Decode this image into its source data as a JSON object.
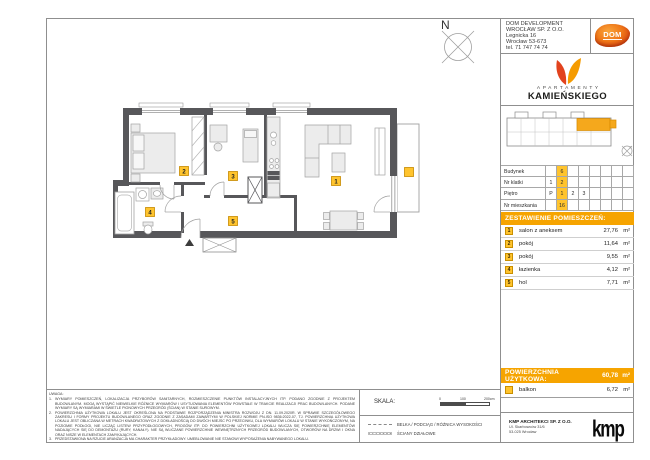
{
  "colors": {
    "accent_orange": "#F6A400",
    "highlight_yellow": "#FFC42E",
    "wall_gray": "#57575A",
    "logo_red": "#E2431E",
    "logo_orange": "#F59B00"
  },
  "header": {
    "developer_lines": [
      "DOM DEVELOPMENT",
      "WROCŁAW SP. Z O.O.",
      "Legnicka 16",
      "Wrocław 53-673",
      "tel. 71 747 74 74"
    ],
    "dom_logo_text": "DOM",
    "brand_sub": "APARTAMENTY",
    "brand_main": "KAMIEŃSKIEGO"
  },
  "compass_label": "N",
  "unit_table": {
    "rows": [
      {
        "label": "Budynek",
        "cells": [
          "",
          "6",
          "",
          "",
          "",
          "",
          "",
          ""
        ]
      },
      {
        "label": "Nr klatki",
        "cells": [
          "1",
          "2",
          "",
          "",
          "",
          "",
          "",
          ""
        ]
      },
      {
        "label": "Piętro",
        "cells": [
          "P",
          "1",
          "2",
          "3",
          "",
          "",
          "",
          ""
        ]
      },
      {
        "label": "Nr mieszkania",
        "cells": [
          "",
          "16",
          "",
          "",
          "",
          "",
          "",
          ""
        ]
      }
    ]
  },
  "rooms": {
    "title": "ZESTAWIENIE POMIESZCZEŃ:",
    "items": [
      {
        "no": "1",
        "name": "salon z aneksem",
        "area": "27,76",
        "unit": "m²"
      },
      {
        "no": "2",
        "name": "pokój",
        "area": "11,64",
        "unit": "m²"
      },
      {
        "no": "3",
        "name": "pokój",
        "area": "9,55",
        "unit": "m²"
      },
      {
        "no": "4",
        "name": "łazienka",
        "area": "4,12",
        "unit": "m²"
      },
      {
        "no": "5",
        "name": "hol",
        "area": "7,71",
        "unit": "m²"
      }
    ]
  },
  "summary": {
    "title": "POWIERZCHNIA UŻYTKOWA:",
    "value": "60,78",
    "unit": "m²",
    "balkon_name": "balkon",
    "balkon_area": "6,72",
    "balkon_unit": "m²"
  },
  "architect": {
    "name": "KMP ARCHITEKCI SP. Z O.O.",
    "address1": "Ul. Skarbowców 31/6",
    "address2": "53-025 Wrocław",
    "logo_text": "kmp"
  },
  "scale": {
    "label": "SKALA:",
    "ticks": [
      "0",
      "100",
      "200cm"
    ]
  },
  "legend": {
    "items": [
      {
        "label": "BELKA / PODCIĄG / RÓŻNICA WYSOKOŚCI"
      },
      {
        "label": "ŚCIANY DZIAŁOWE"
      }
    ]
  },
  "notes": {
    "title": "UWAGA:",
    "items": [
      {
        "no": "1.",
        "text": "WYMIARY POMIESZCZEŃ, LOKALIZACJA PRZYBORÓW SANITARNYCH, ROZMIESZCZENIE PUNKTÓW INSTALACYJNYCH ITP. PODANO ZGODNIE Z PROJEKTEM BUDOWLANYM. MOGĄ WYSTĄPIĆ NIEWIELKIE RÓŻNICE WYMIARÓW I USYTUOWANIA ELEMENTÓW POWSTAŁE W TRAKCIE REALIZACJI PRAC BUDOWLANYCH. PODANE WYMIARY SĄ WYMIARAMI W ŚWIETLE PIONOWYCH PRZEGRÓD (ŚCIAN) W STANIE SUROWYM."
      },
      {
        "no": "2.",
        "text": "POWIERZCHNIA UŻYTKOWA LOKALU JEST OKREŚLONA NA PODSTAWIE ROZPORZĄDZENIA MINISTRA ROZWOJU Z DN. 11.09.2020R. W SPRAWIE SZCZEGÓŁOWEGO ZAKRESU I FORMY PROJEKTU BUDOWLANEGO ORAZ ZGODNIE Z ZASADAMI ZAWARTYMI W POLSKIEJ NORMIE PN-ISO 9836:2022-07, TJ. POWIERZCHNIA UŻYTKOWA LOKALU JEST OBLICZANA W METRACH KWADRATOWYCH Z DOKŁADNOŚCIĄ DO DWÓCH MIEJSC PO PRZECINKU, DLA WYMIARÓW LOKALU W STANIE WYKOŃCZONYM, NA POZIOMIE PODŁOGI, NIE LICZĄC LISTEW PRZYPODŁOGOWYCH, PROGÓW ITP. DO POWIERZCHNI UŻYTKOWEJ LOKALU WLICZA SIĘ POWIERZCHNIĘ ELEMENTÓW NADAJĄCYCH SIĘ DO DEMONTAŻU (RURY, KANAŁY). NIE SĄ WLICZANE POWIERZCHNIE WEWNĘTRZNYCH PRZEGRÓD BUDOWLANYCH, OTWORÓW NA DRZWI I OKNA ORAZ NISZE W ELEMENTACH ZAMYKAJĄCYCH."
      },
      {
        "no": "3.",
        "text": "PRZEDSTAWIONA NA RZUCIE ARANŻACJA MA CHARAKTER PRZYKŁADOWY. UMEBLOWANIE NIE STANOWI WYPOSAŻENIA NABYWANEGO LOKALU."
      }
    ]
  }
}
